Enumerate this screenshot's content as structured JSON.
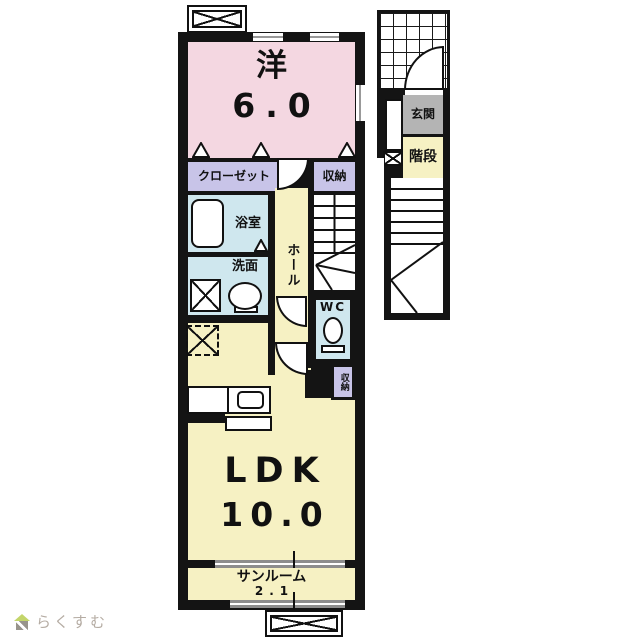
{
  "plan": {
    "title_hint": "apartment-floor-plan",
    "building": {
      "western": {
        "label": "洋",
        "size": "6.0"
      },
      "closet": {
        "label": "クローゼット"
      },
      "storage_top": {
        "label": "収納"
      },
      "bath": {
        "label": "浴室"
      },
      "hall": {
        "label": "ホール"
      },
      "washroom": {
        "label": "洗面"
      },
      "wc": {
        "label": "WC"
      },
      "storage_small": {
        "label": "収納"
      },
      "ldk": {
        "label": "LDK",
        "size": "10.0"
      },
      "sunroom": {
        "label": "サンルーム",
        "size": "2.1"
      }
    },
    "annex": {
      "entrance": {
        "label": "玄関"
      },
      "stairs": {
        "label": "階段"
      }
    },
    "colors": {
      "wall": "#141414",
      "western_room": "#f4d7e1",
      "ldk_hall_stairs": "#f6f1c3",
      "wet_areas": "#cfe7ee",
      "storage": "#c8c4e8",
      "entrance_gray": "#b4b4b4",
      "window_gray": "#8d8d8d"
    }
  },
  "watermark": {
    "text": "らくすむ"
  }
}
